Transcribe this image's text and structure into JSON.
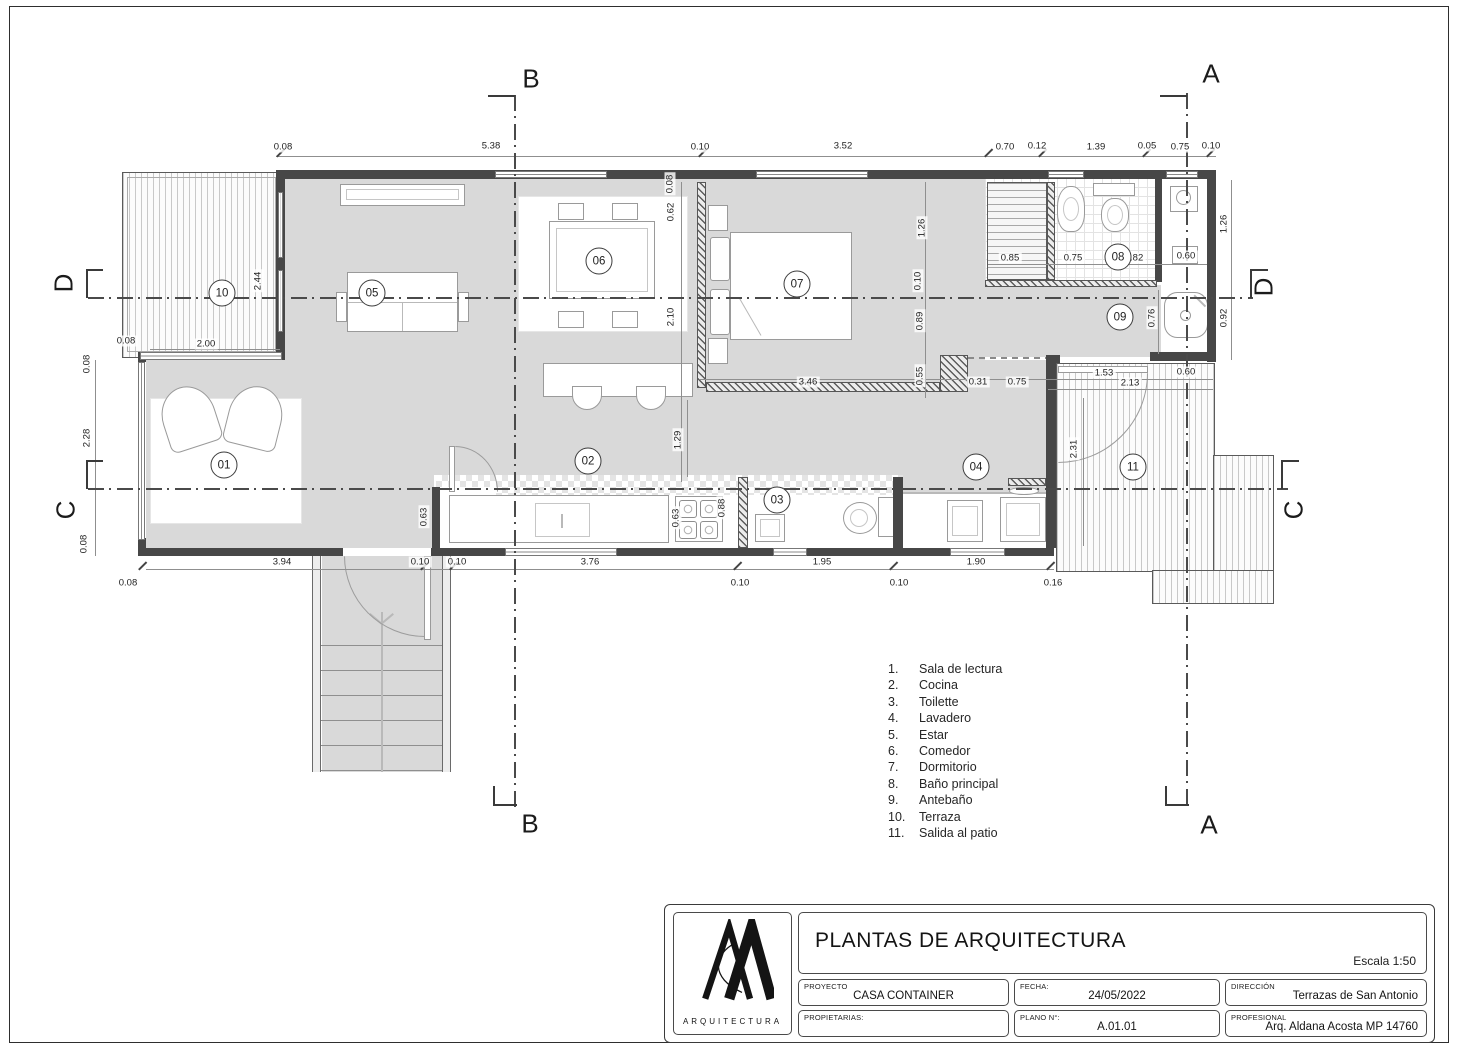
{
  "colors": {
    "floor": "#d9d9d9",
    "wall": "#474747",
    "deck_stripe": "#c9c9c9"
  },
  "plan": {
    "section_letters": [
      {
        "t": "B",
        "x": 531,
        "y": 79
      },
      {
        "t": "A",
        "x": 1211,
        "y": 74
      },
      {
        "t": "B",
        "x": 530,
        "y": 824
      },
      {
        "t": "A",
        "x": 1209,
        "y": 825
      },
      {
        "t": "D",
        "x": 64,
        "y": 283,
        "r": -90
      },
      {
        "t": "C",
        "x": 66,
        "y": 510,
        "r": -90
      },
      {
        "t": "D",
        "x": 1264,
        "y": 287,
        "r": -90
      },
      {
        "t": "C",
        "x": 1294,
        "y": 510,
        "r": -90
      }
    ],
    "room_markers": [
      {
        "t": "01",
        "x": 224,
        "y": 465
      },
      {
        "t": "02",
        "x": 588,
        "y": 461
      },
      {
        "t": "03",
        "x": 777,
        "y": 500
      },
      {
        "t": "04",
        "x": 976,
        "y": 467
      },
      {
        "t": "05",
        "x": 372,
        "y": 293
      },
      {
        "t": "06",
        "x": 599,
        "y": 261
      },
      {
        "t": "07",
        "x": 797,
        "y": 284
      },
      {
        "t": "08",
        "x": 1118,
        "y": 257
      },
      {
        "t": "09",
        "x": 1120,
        "y": 317
      },
      {
        "t": "10",
        "x": 222,
        "y": 293
      },
      {
        "t": "11",
        "x": 1133,
        "y": 467
      }
    ],
    "dim_labels": [
      {
        "t": "0.08",
        "x": 283,
        "y": 147
      },
      {
        "t": "5.38",
        "x": 491,
        "y": 146
      },
      {
        "t": "0.10",
        "x": 700,
        "y": 147
      },
      {
        "t": "3.52",
        "x": 843,
        "y": 146
      },
      {
        "t": "0.70",
        "x": 1005,
        "y": 147
      },
      {
        "t": "0.12",
        "x": 1037,
        "y": 146
      },
      {
        "t": "1.39",
        "x": 1096,
        "y": 147
      },
      {
        "t": "0.05",
        "x": 1147,
        "y": 146
      },
      {
        "t": "0.75",
        "x": 1180,
        "y": 147
      },
      {
        "t": "0.10",
        "x": 1211,
        "y": 146
      },
      {
        "t": "2.44",
        "x": 258,
        "y": 281,
        "r": -90
      },
      {
        "t": "0.08",
        "x": 126,
        "y": 341
      },
      {
        "t": "2.00",
        "x": 206,
        "y": 344
      },
      {
        "t": "0.08",
        "x": 87,
        "y": 364,
        "r": -90
      },
      {
        "t": "2.28",
        "x": 87,
        "y": 438,
        "r": -90
      },
      {
        "t": "0.08",
        "x": 84,
        "y": 544,
        "r": -90
      },
      {
        "t": "0.08",
        "x": 128,
        "y": 583
      },
      {
        "t": "0.08",
        "x": 670,
        "y": 184,
        "r": -90
      },
      {
        "t": "0.62",
        "x": 671,
        "y": 212,
        "r": -90
      },
      {
        "t": "2.10",
        "x": 671,
        "y": 317,
        "r": -90
      },
      {
        "t": "1.29",
        "x": 678,
        "y": 440,
        "r": -90
      },
      {
        "t": "1.26",
        "x": 922,
        "y": 228,
        "r": -90
      },
      {
        "t": "0.10",
        "x": 918,
        "y": 281,
        "r": -90
      },
      {
        "t": "0.89",
        "x": 920,
        "y": 321,
        "r": -90
      },
      {
        "t": "0.55",
        "x": 920,
        "y": 376,
        "r": -90
      },
      {
        "t": "0.85",
        "x": 1010,
        "y": 258
      },
      {
        "t": "0.75",
        "x": 1073,
        "y": 258
      },
      {
        "t": "0.82",
        "x": 1134,
        "y": 258
      },
      {
        "t": "0.60",
        "x": 1186,
        "y": 256
      },
      {
        "t": "1.26",
        "x": 1224,
        "y": 224,
        "r": -90
      },
      {
        "t": "0.92",
        "x": 1224,
        "y": 318,
        "r": -90
      },
      {
        "t": "0.76",
        "x": 1152,
        "y": 318,
        "r": -90
      },
      {
        "t": "3.46",
        "x": 808,
        "y": 382
      },
      {
        "t": "0.31",
        "x": 978,
        "y": 382
      },
      {
        "t": "0.75",
        "x": 1017,
        "y": 382
      },
      {
        "t": "1.53",
        "x": 1104,
        "y": 373
      },
      {
        "t": "0.60",
        "x": 1186,
        "y": 372
      },
      {
        "t": "2.13",
        "x": 1130,
        "y": 383
      },
      {
        "t": "2.31",
        "x": 1074,
        "y": 449,
        "r": -90
      },
      {
        "t": "0.63",
        "x": 424,
        "y": 517,
        "r": -90
      },
      {
        "t": "0.63",
        "x": 676,
        "y": 518,
        "r": -90
      },
      {
        "t": "0.88",
        "x": 722,
        "y": 508,
        "r": -90
      },
      {
        "t": "3.94",
        "x": 282,
        "y": 562
      },
      {
        "t": "0.10",
        "x": 420,
        "y": 562
      },
      {
        "t": "0.10",
        "x": 457,
        "y": 562
      },
      {
        "t": "3.76",
        "x": 590,
        "y": 562
      },
      {
        "t": "1.95",
        "x": 822,
        "y": 562
      },
      {
        "t": "1.90",
        "x": 976,
        "y": 562
      },
      {
        "t": "0.10",
        "x": 740,
        "y": 583
      },
      {
        "t": "0.10",
        "x": 899,
        "y": 583
      },
      {
        "t": "0.16",
        "x": 1053,
        "y": 583
      }
    ]
  },
  "legend": {
    "items": [
      {
        "num": "1.",
        "label": "Sala de lectura"
      },
      {
        "num": "2.",
        "label": "Cocina"
      },
      {
        "num": "3.",
        "label": "Toilette"
      },
      {
        "num": "4.",
        "label": "Lavadero"
      },
      {
        "num": "5.",
        "label": "Estar"
      },
      {
        "num": "6.",
        "label": "Comedor"
      },
      {
        "num": "7.",
        "label": "Dormitorio"
      },
      {
        "num": "8.",
        "label": "Baño principal"
      },
      {
        "num": "9.",
        "label": "Antebaño"
      },
      {
        "num": "10.",
        "label": "Terraza"
      },
      {
        "num": "11.",
        "label": "Salida al patio"
      }
    ]
  },
  "titleblock": {
    "title": "PLANTAS DE ARQUITECTURA",
    "scale": "Escala 1:50",
    "logo_text": "ARQUITECTURA",
    "fields": [
      {
        "label": "PROYECTO",
        "value": "CASA CONTAINER"
      },
      {
        "label": "FECHA:",
        "value": "24/05/2022"
      },
      {
        "label": "DIRECCIÓN",
        "value": "Terrazas de San Antonio"
      },
      {
        "label": "PROPIETARIAS:",
        "value": ""
      },
      {
        "label": "PLANO N°:",
        "value": "A.01.01"
      },
      {
        "label": "PROFESIONAL",
        "value": "Arq. Aldana Acosta MP 14760"
      }
    ]
  }
}
